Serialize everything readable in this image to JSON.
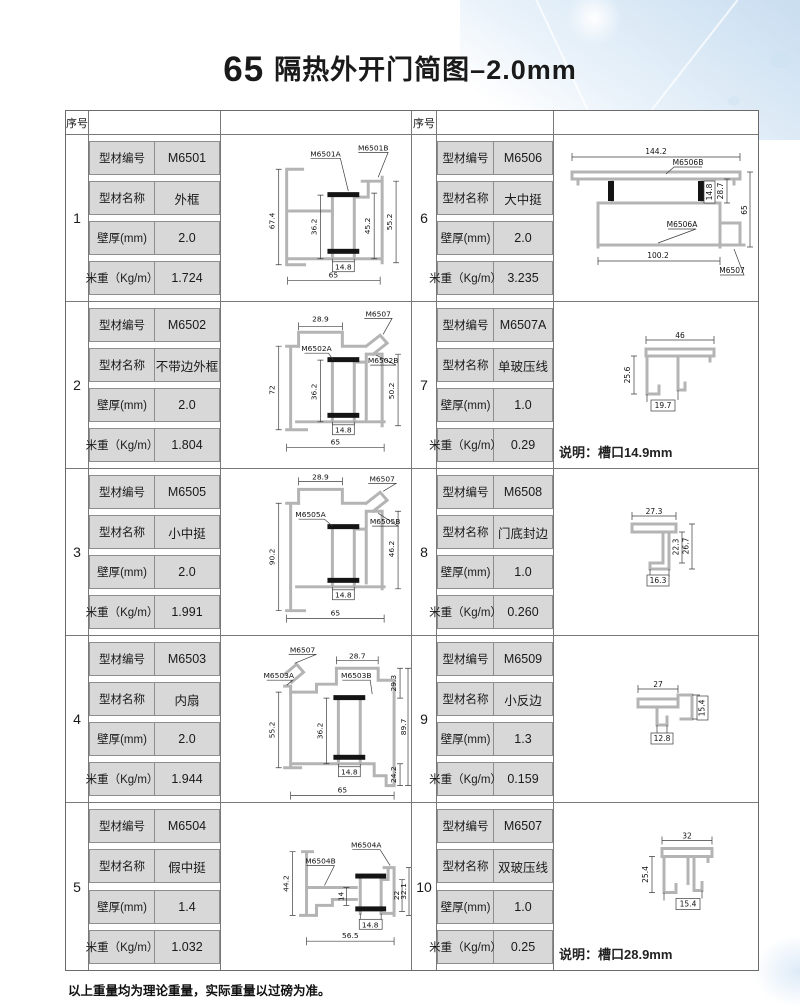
{
  "page": {
    "title_number": "65",
    "title_text": "隔热外开门简图–2.0mm",
    "seq_header": "序号",
    "footer": "以上重量均为理论重量，实际重量以过磅为准。"
  },
  "field_labels": [
    "型材编号",
    "型材名称",
    "壁厚(mm)",
    "米重（Kg/m）"
  ],
  "entries": [
    {
      "no": "1",
      "code": "M6501",
      "name": "外框",
      "thickness": "2.0",
      "weight": "1.724",
      "dims": [
        "67.4",
        "36.2",
        "45.2",
        "55.2",
        "14.8",
        "65"
      ],
      "labels": [
        "M6501A",
        "M6501B"
      ]
    },
    {
      "no": "2",
      "code": "M6502",
      "name": "不带边外框",
      "thickness": "2.0",
      "weight": "1.804",
      "dims": [
        "28.9",
        "72",
        "36.2",
        "50.2",
        "14.8",
        "65"
      ],
      "labels": [
        "M6507",
        "M6502A",
        "M6502B"
      ]
    },
    {
      "no": "3",
      "code": "M6505",
      "name": "小中挺",
      "thickness": "2.0",
      "weight": "1.991",
      "dims": [
        "28.9",
        "90.2",
        "46.2",
        "14.8",
        "65"
      ],
      "labels": [
        "M6507",
        "M6505A",
        "M6505B"
      ]
    },
    {
      "no": "4",
      "code": "M6503",
      "name": "内扇",
      "thickness": "2.0",
      "weight": "1.944",
      "dims": [
        "28.7",
        "29.3",
        "55.2",
        "36.2",
        "89.7",
        "14.8",
        "24.2",
        "65"
      ],
      "labels": [
        "M6507",
        "M6503A",
        "M6503B"
      ]
    },
    {
      "no": "5",
      "code": "M6504",
      "name": "假中挺",
      "thickness": "1.4",
      "weight": "1.032",
      "dims": [
        "44.2",
        "14",
        "22",
        "32.1",
        "14.8",
        "56.5"
      ],
      "labels": [
        "M6504B",
        "M6504A"
      ]
    },
    {
      "no": "6",
      "code": "M6506",
      "name": "大中挺",
      "thickness": "2.0",
      "weight": "3.235",
      "dims": [
        "144.2",
        "14.8",
        "28.7",
        "65",
        "100.2"
      ],
      "labels": [
        "M6506B",
        "M6506A",
        "M6507"
      ]
    },
    {
      "no": "7",
      "code": "M6507A",
      "name": "单玻压线",
      "thickness": "1.0",
      "weight": "0.29",
      "dims": [
        "46",
        "25.6",
        "19.7"
      ],
      "labels": [],
      "note": "说明：槽口14.9mm"
    },
    {
      "no": "8",
      "code": "M6508",
      "name": "门底封边",
      "thickness": "1.0",
      "weight": "0.260",
      "dims": [
        "27.3",
        "22.3",
        "26.7",
        "16.3"
      ],
      "labels": []
    },
    {
      "no": "9",
      "code": "M6509",
      "name": "小反边",
      "thickness": "1.3",
      "weight": "0.159",
      "dims": [
        "27",
        "15.4",
        "12.8"
      ],
      "labels": []
    },
    {
      "no": "10",
      "code": "M6507",
      "name": "双玻压线",
      "thickness": "1.0",
      "weight": "0.25",
      "dims": [
        "32",
        "25.4",
        "15.4"
      ],
      "labels": [],
      "note": "说明：槽口28.9mm"
    }
  ]
}
